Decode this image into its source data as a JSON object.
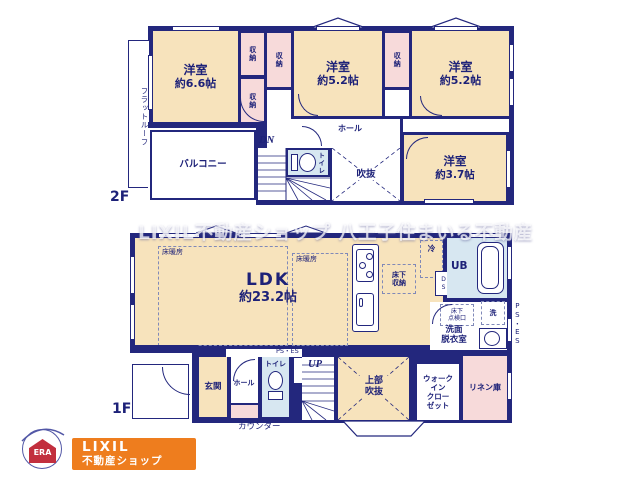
{
  "watermark": "LIXIL不動産ショップ 八王子住まいる不動産",
  "floor2": {
    "floor_label": "2F",
    "flat_roof": "フラットルーフ",
    "room_66": {
      "name": "洋室",
      "size": "約6.6帖"
    },
    "room_52a": {
      "name": "洋室",
      "size": "約5.2帖"
    },
    "room_52b": {
      "name": "洋室",
      "size": "約5.2帖"
    },
    "room_37": {
      "name": "洋室",
      "size": "約3.7帖"
    },
    "closets": [
      "収納",
      "収納",
      "収納",
      "収納"
    ],
    "balcony": "バルコニー",
    "hall": "ホール",
    "toilet": "トイレ",
    "void": "吹抜",
    "stairs_dn": "DN"
  },
  "floor1": {
    "floor_label": "1F",
    "ldk": {
      "name": "LDK",
      "size": "約23.2帖"
    },
    "floor_heating_1": "床暖房",
    "floor_heating_2": "床暖房",
    "underfloor_storage": "床下\n収納",
    "fridge": "冷",
    "unit_bath": "UB",
    "duct_space": "DS",
    "inspection_hatch": "床下\n点検口",
    "washer": "洗",
    "washroom": "洗面\n脱衣室",
    "pipe_space_right": "PS・ES",
    "pipe_space_top": "PS・ES",
    "entrance": "玄関",
    "hall": "ホール",
    "toilet": "トイレ",
    "stairs_up": "UP",
    "upper_void": "上部\n吹抜",
    "walk_in_closet": "ウォーク\nイン\nクロー\nゼット",
    "linen": "リネン庫",
    "counter": "カウンター"
  },
  "logo": {
    "era": "ERA",
    "shop_line1": "LIXIL",
    "shop_line2": "不動産ショップ"
  },
  "colors": {
    "wall": "#23277d",
    "room_cream": "#f7e3bc",
    "closet_pink": "#f7dada",
    "wet_blue": "#d7e7f1",
    "logo_orange": "#ee7d1e"
  }
}
